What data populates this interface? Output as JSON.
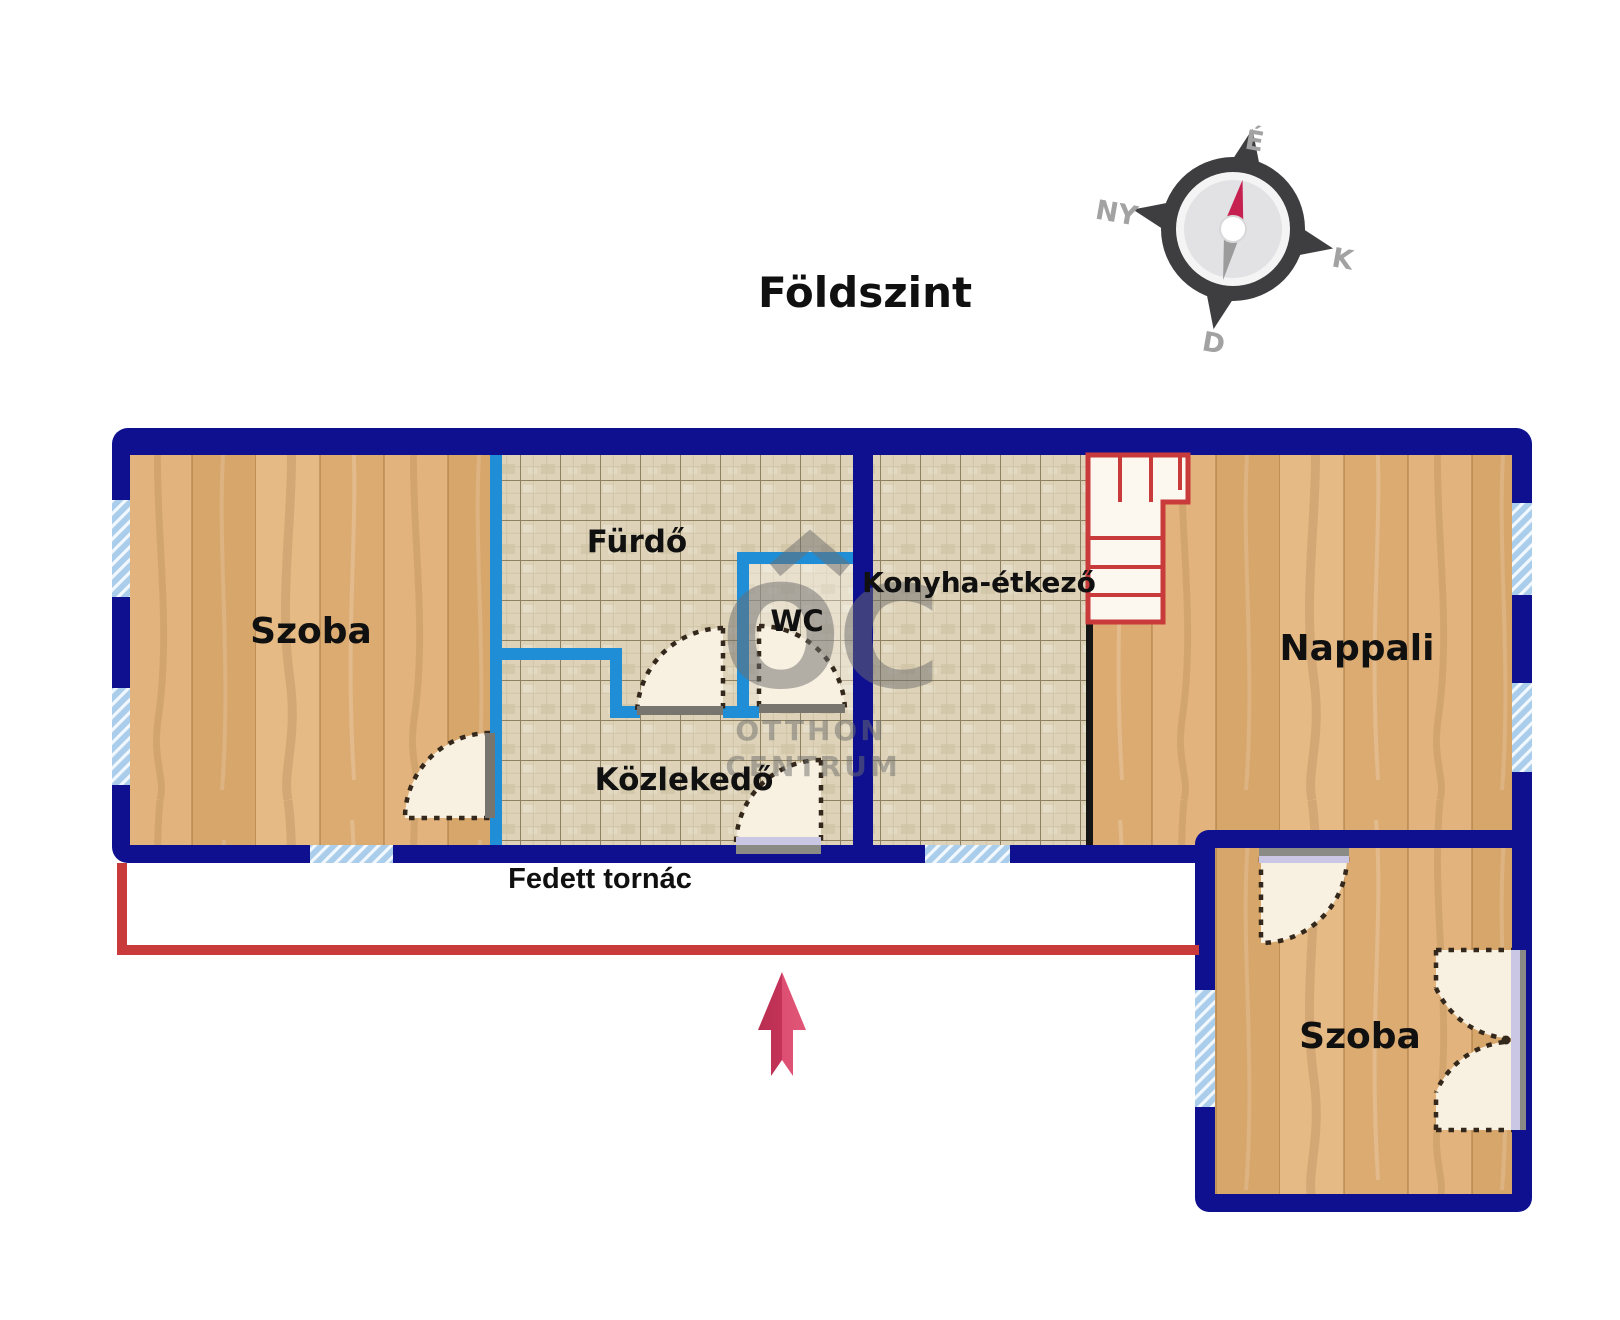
{
  "plan": {
    "title": "Földszint",
    "rooms": {
      "room_top_left": "Szoba",
      "bathroom": "Fürdő",
      "wc": "WC",
      "kitchen_dining": "Konyha-étkező",
      "hallway": "Közlekedő",
      "living_room": "Nappali",
      "covered_porch": "Fedett tornác",
      "room_bottom_right": "Szoba"
    },
    "compass": {
      "north_label": "É",
      "west_label": "NY",
      "east_label": "K",
      "south_label": "D"
    },
    "watermark": {
      "monogram": "OC",
      "name_line1": "OTTHON",
      "name_line2": "CENTRUM"
    },
    "colors": {
      "wall_navy": "#0e1090",
      "partition_blue": "#1f8ed6",
      "window_light_blue": "#a9cdea",
      "stair_porch_red": "#c93a3a",
      "entrance_arrow_red": "#d23a5c",
      "wood_floor": "#e0b078",
      "tile_floor": "#ded3b8",
      "door_leaf_fill": "#f8f0e0"
    }
  }
}
